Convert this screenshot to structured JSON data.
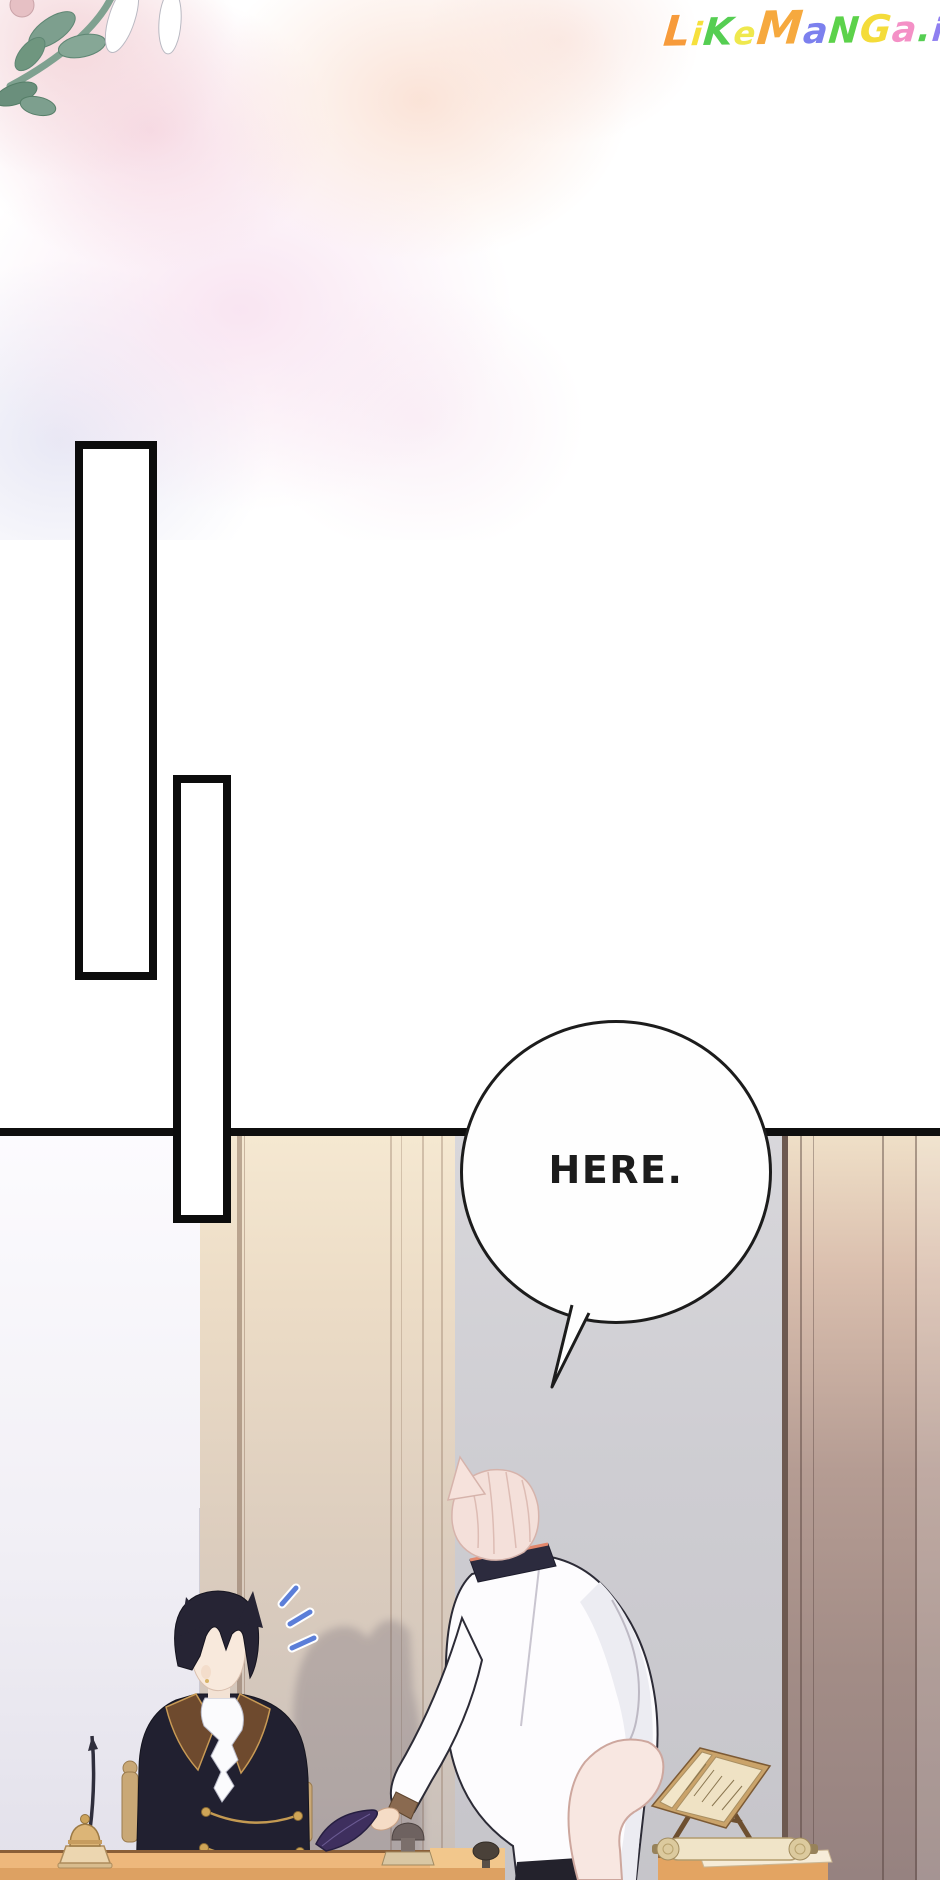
{
  "page": {
    "width": 940,
    "height": 1880,
    "kind": "manga-reader-page"
  },
  "watermark": {
    "text": "LikeManga.io",
    "letters": [
      {
        "ch": "L",
        "color": "#F79B3B",
        "size": 42
      },
      {
        "ch": "i",
        "color": "#F6E03C",
        "size": 32
      },
      {
        "ch": "K",
        "color": "#55CE52",
        "size": 38
      },
      {
        "ch": "e",
        "color": "#EFE84D",
        "size": 32
      },
      {
        "ch": "M",
        "color": "#F6A93E",
        "size": 46
      },
      {
        "ch": "a",
        "color": "#7C80EE",
        "size": 36
      },
      {
        "ch": "N",
        "color": "#5CD24A",
        "size": 36
      },
      {
        "ch": "G",
        "color": "#F4DC3A",
        "size": 38
      },
      {
        "ch": "a",
        "color": "#F490C6",
        "size": 36
      },
      {
        "ch": ".",
        "color": "#55CE52",
        "size": 36
      },
      {
        "ch": "i",
        "color": "#8F7FF0",
        "size": 32
      },
      {
        "ch": "o",
        "color": "#F2506A",
        "size": 40
      }
    ]
  },
  "speech_bubble": {
    "text": "HERE."
  },
  "scene_elements": [
    "watercolor-flower",
    "empty-panel-rect-1",
    "empty-panel-rect-2",
    "seated-cat-eared-character",
    "standing-cat-eared-character",
    "surprise-notice-marks",
    "wall-shadow",
    "desk",
    "side-table",
    "quill-pen",
    "bell-inkstand",
    "purple-feather",
    "seal-stamp",
    "book-stand",
    "scroll"
  ],
  "palette": {
    "page_bg": "#ffffff",
    "ink": "#1c1c1c",
    "panel_line": "#0f0f0f",
    "bubble_fill": "#fefefe",
    "wall_gray": "#cdccd1",
    "wall_bright": "#f2f0f6",
    "wall_beige": "#e6d6c2",
    "wall_mauve": "#a8918b",
    "desk_wood": "#eeb87c",
    "desk_wood_dark": "#dda162",
    "notice_blue": "#5b7ed8",
    "hair_dark": "#262434",
    "hair_pink": "#f2dcd6",
    "coat_white": "#fdfcfe",
    "jacket_dark": "#212030",
    "lapel_brown": "#6e4a2e",
    "lapel_gold": "#c89a55",
    "skin": "#f5e3d3",
    "feather_purple": "#3e2f5e",
    "tail_pink": "#f8e7e1",
    "leaf_green": "#7d9f8e",
    "wash_pink": "#f6d7e0"
  }
}
